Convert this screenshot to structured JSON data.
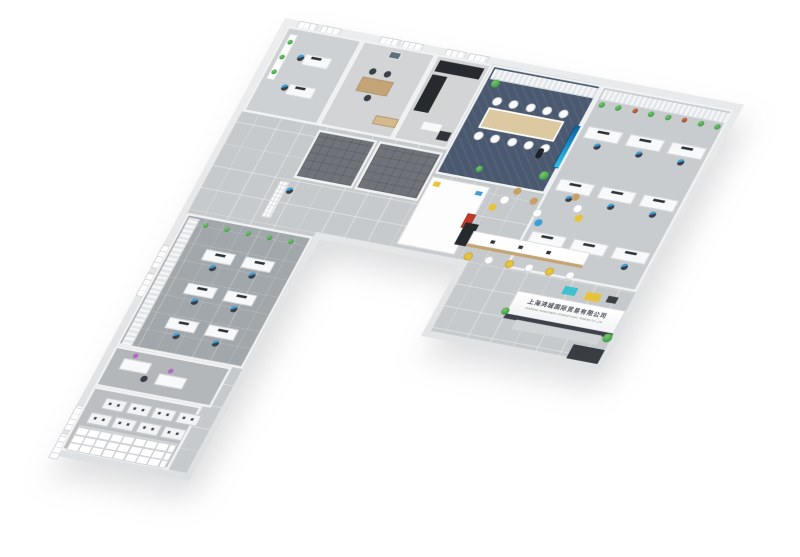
{
  "scene": {
    "description": "3D axonometric render of an L-shaped office floor plan on white background"
  },
  "palette": {
    "background": "#ffffff",
    "outer_wall": "#d9dcde",
    "inner_wall": "#f0f2f3",
    "tile_floor": "#c7cacc",
    "dark_tile": "#70747a",
    "conference_carpet": "#4a5970",
    "wing_carpet": "#a2a7ab",
    "desk_white": "#f8f9fa",
    "wood": "#c3a476",
    "chair_dark": "#39404a",
    "accent_blue": "#3f9ed6",
    "accent_yellow": "#e7c33c",
    "accent_purple": "#b267c6",
    "plant_green": "#3f9e4d",
    "logo_red": "#c23b2a",
    "cabinet_black": "#26292e",
    "screen_blue": "#1b86c8"
  },
  "reception_sign": {
    "chinese": "上海鸿城国际贸易有限公司",
    "english": "SHANGHAI HONGCHENG INTERNATIONAL TRADING CO.,LTD"
  },
  "counts": {
    "conference_chairs_per_side": 5,
    "bar_stools": 6,
    "workstations": 9,
    "cluster_desks": 6,
    "hanging_plants": 8,
    "wing_shelf_plants": 5,
    "office_shelf_plants": 3,
    "archive_cabinets_per_row": 4
  }
}
